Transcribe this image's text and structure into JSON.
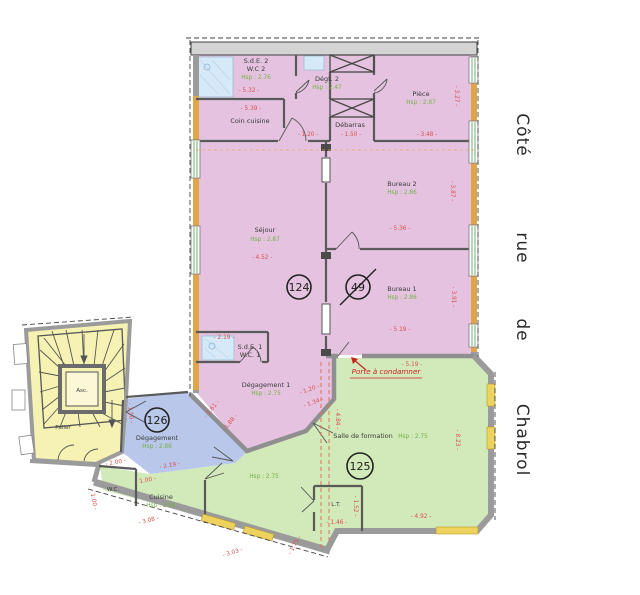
{
  "palette": {
    "lot124_pink": "#e5c3e0",
    "lot125_green": "#d2e9ba",
    "lot126_blue": "#b8c7ea",
    "palier_yellow": "#f6f2b3",
    "facade_orange": "#dfa54a",
    "window_yellow": "#eed25e",
    "dimension_red": "#d95050",
    "height_green": "#74b044",
    "wall_gray": "#9b9b9b"
  },
  "street": {
    "full_text": "Côté rue de Chabrol",
    "words": [
      {
        "t": "Côté",
        "x": 517,
        "y": 135
      },
      {
        "t": "rue",
        "x": 517,
        "y": 248
      },
      {
        "t": "de",
        "x": 517,
        "y": 330
      },
      {
        "t": "Chabrol",
        "x": 517,
        "y": 440
      }
    ]
  },
  "annotation": {
    "t": "Porte à condamner",
    "x": 386,
    "y": 374
  },
  "lots": [
    {
      "n": "124",
      "x": 299,
      "y": 287,
      "r": 12,
      "struck": false
    },
    {
      "n": "49",
      "x": 358,
      "y": 287,
      "r": 12,
      "struck": true
    },
    {
      "n": "126",
      "x": 157,
      "y": 420,
      "r": 12,
      "struck": false
    },
    {
      "n": "125",
      "x": 360,
      "y": 466,
      "r": 13,
      "struck": false
    }
  ],
  "labels": [
    {
      "t": "S.d.E. 2",
      "x": 256,
      "y": 63,
      "c": "room"
    },
    {
      "t": "W.C 2",
      "x": 256,
      "y": 71,
      "c": "room"
    },
    {
      "t": "Hsp : 2.76",
      "x": 256,
      "y": 79,
      "c": "hsp"
    },
    {
      "t": "- 5.32 -",
      "x": 249,
      "y": 92,
      "c": "dim"
    },
    {
      "t": "- 5.39 -",
      "x": 251,
      "y": 110,
      "c": "dim"
    },
    {
      "t": "Coin cuisine",
      "x": 250,
      "y": 123,
      "c": "room"
    },
    {
      "t": "Dégt. 2",
      "x": 327,
      "y": 81,
      "c": "room"
    },
    {
      "t": "Hsp : 2.47",
      "x": 327,
      "y": 89,
      "c": "hsp"
    },
    {
      "t": "Pièce",
      "x": 421,
      "y": 96,
      "c": "room"
    },
    {
      "t": "Hsp : 2.87",
      "x": 421,
      "y": 104,
      "c": "hsp"
    },
    {
      "t": "Débarras",
      "x": 350,
      "y": 127,
      "c": "room"
    },
    {
      "t": "- 1.20 -",
      "x": 308,
      "y": 136,
      "c": "dim"
    },
    {
      "t": "- 1.50 -",
      "x": 351,
      "y": 136,
      "c": "dim"
    },
    {
      "t": "- 3.48 -",
      "x": 427,
      "y": 136,
      "c": "dim"
    },
    {
      "t": "Séjour",
      "x": 265,
      "y": 232,
      "c": "room"
    },
    {
      "t": "Hsp : 2.87",
      "x": 265,
      "y": 241,
      "c": "hsp"
    },
    {
      "t": "- 4.52 -",
      "x": 262,
      "y": 259,
      "c": "dim"
    },
    {
      "t": "Bureau 2",
      "x": 402,
      "y": 186,
      "c": "room"
    },
    {
      "t": "Hsp : 2.86",
      "x": 402,
      "y": 194,
      "c": "hsp"
    },
    {
      "t": "- 5.36 -",
      "x": 400,
      "y": 230,
      "c": "dim"
    },
    {
      "t": "Bureau 1",
      "x": 402,
      "y": 291,
      "c": "room"
    },
    {
      "t": "Hsp : 2.86",
      "x": 402,
      "y": 299,
      "c": "hsp"
    },
    {
      "t": "- 5.19 -",
      "x": 400,
      "y": 331,
      "c": "dim"
    },
    {
      "t": "- 3.27 -",
      "x": 455,
      "y": 96,
      "c": "dim",
      "r": 90
    },
    {
      "t": "- 3.87 -",
      "x": 451,
      "y": 191,
      "c": "dim",
      "r": 90
    },
    {
      "t": "- 3.91 -",
      "x": 452,
      "y": 297,
      "c": "dim",
      "r": 90
    },
    {
      "t": "- 2.19 -",
      "x": 224,
      "y": 339,
      "c": "dim"
    },
    {
      "t": "S.d.E. 1",
      "x": 250,
      "y": 349,
      "c": "room"
    },
    {
      "t": "W.C. 1",
      "x": 250,
      "y": 357,
      "c": "room"
    },
    {
      "t": "Dégagement 1",
      "x": 266,
      "y": 387,
      "c": "room"
    },
    {
      "t": "Hsp : 2.75",
      "x": 266,
      "y": 395,
      "c": "hsp"
    },
    {
      "t": "- 1.20 -",
      "x": 310,
      "y": 391,
      "c": "dim",
      "r": -20
    },
    {
      "t": "- 1.34 -",
      "x": 314,
      "y": 404,
      "c": "dim",
      "r": -20
    },
    {
      "t": "- 5.19 -",
      "x": 412,
      "y": 366,
      "c": "dim"
    },
    {
      "t": "- 1.61 -",
      "x": 213,
      "y": 410,
      "c": "dim",
      "r": -50
    },
    {
      "t": "- 1.88 -",
      "x": 231,
      "y": 424,
      "c": "dim",
      "r": -50
    },
    {
      "t": "- 1.50 -",
      "x": 129,
      "y": 413,
      "c": "dim",
      "r": 85
    },
    {
      "t": "Dégagement",
      "x": 157,
      "y": 440,
      "c": "room"
    },
    {
      "t": "Hsp : 2.86",
      "x": 157,
      "y": 448,
      "c": "hsp"
    },
    {
      "t": "- 2.00 -",
      "x": 116,
      "y": 464,
      "c": "dim",
      "r": -10
    },
    {
      "t": "- 2.19 -",
      "x": 170,
      "y": 467,
      "c": "dim",
      "r": -10
    },
    {
      "t": "W.C.",
      "x": 113,
      "y": 491,
      "c": "room small"
    },
    {
      "t": "- 1.00 -",
      "x": 92,
      "y": 500,
      "c": "dim",
      "r": 80
    },
    {
      "t": "- 1.00 -",
      "x": 146,
      "y": 482,
      "c": "dim",
      "r": -10
    },
    {
      "t": "Cuisine",
      "x": 161,
      "y": 499,
      "c": "room"
    },
    {
      "t": "Hsp : 2.86",
      "x": 161,
      "y": 507,
      "c": "hsp"
    },
    {
      "t": "- 3.08 -",
      "x": 149,
      "y": 522,
      "c": "dim",
      "r": -14
    },
    {
      "t": "Hsp : 2.75",
      "x": 264,
      "y": 478,
      "c": "hsp"
    },
    {
      "t": "Salle de formation",
      "x": 363,
      "y": 438,
      "c": "room"
    },
    {
      "t": "Hsp : 2.75",
      "x": 413,
      "y": 438,
      "c": "hsp"
    },
    {
      "t": "- 4.84 -",
      "x": 336,
      "y": 419,
      "c": "dim",
      "r": 90
    },
    {
      "t": "- 8.23 -",
      "x": 456,
      "y": 440,
      "c": "dim",
      "r": 90
    },
    {
      "t": "L.T.",
      "x": 336,
      "y": 506,
      "c": "room small"
    },
    {
      "t": "- 1.52 -",
      "x": 354,
      "y": 506,
      "c": "dim",
      "r": 90
    },
    {
      "t": "- 1.46 -",
      "x": 337,
      "y": 524,
      "c": "dim"
    },
    {
      "t": "- 4.92 -",
      "x": 421,
      "y": 518,
      "c": "dim"
    },
    {
      "t": "- 3.03 -",
      "x": 233,
      "y": 554,
      "c": "dim",
      "r": -17
    },
    {
      "t": "- 1.75 -",
      "x": 296,
      "y": 546,
      "c": "dim",
      "r": -60
    },
    {
      "t": "Asc.",
      "x": 82,
      "y": 392,
      "c": "room small"
    },
    {
      "t": "Palier",
      "x": 63,
      "y": 429,
      "c": "room small"
    }
  ]
}
